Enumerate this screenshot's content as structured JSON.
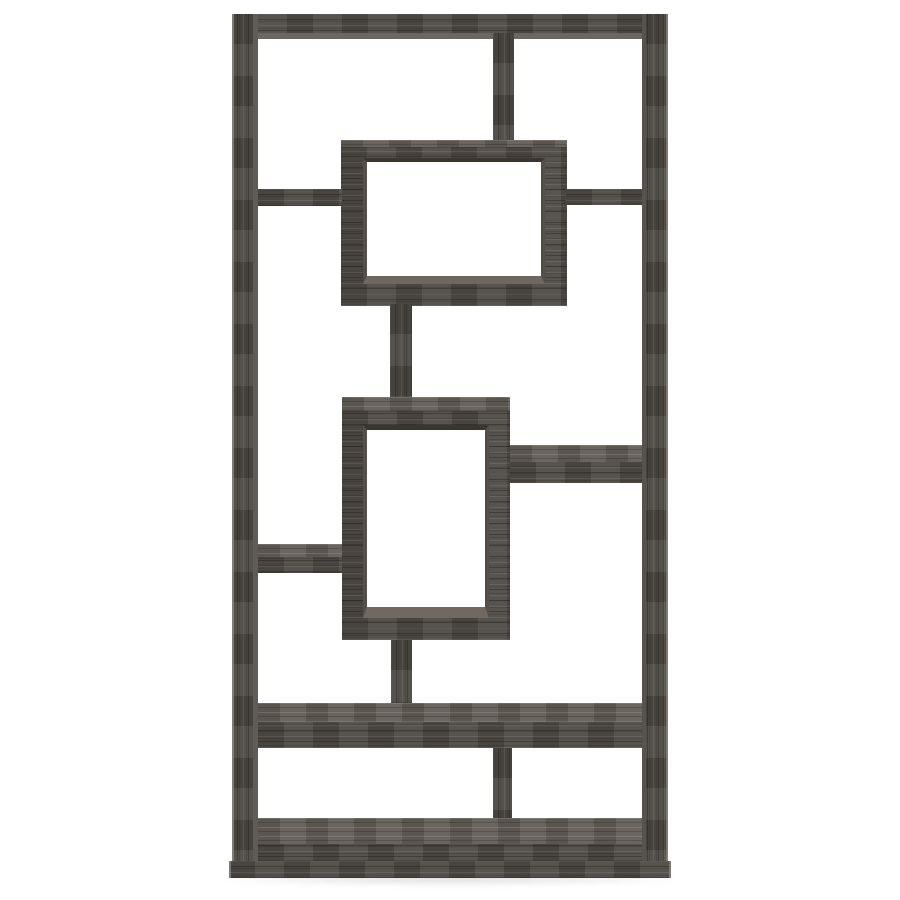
{
  "scene": {
    "type": "product-photograph",
    "alt": "Weathered grey geometric bookcase with interlocking open shelves on a white background",
    "object_name": "10-shelf geometric bookcase",
    "finish_name": "weathered grey rustic woodgrain",
    "background_color": "#ffffff",
    "palette": {
      "wood_front": "#4e4a45",
      "wood_top_face": "#615b54",
      "wood_streak_light": "#756e65",
      "wood_streak_dark": "#39352f",
      "edge_highlight": "#8d8780",
      "interior_shadow": "#3a362f",
      "interior_lit": "#6f6962",
      "floor_shadow": "rgba(0,0,0,0.14)"
    }
  },
  "parts": [
    {
      "id": "top-board",
      "label": "top panel"
    },
    {
      "id": "left-post",
      "label": "left side panel"
    },
    {
      "id": "right-post",
      "label": "right side panel"
    },
    {
      "id": "top-divider",
      "label": "upper vertical divider"
    },
    {
      "id": "upper-box",
      "label": "upper floating shelf box"
    },
    {
      "id": "top-left-shelf",
      "label": "upper left shelf"
    },
    {
      "id": "top-right-shelf",
      "label": "upper right shelf"
    },
    {
      "id": "upper-stem",
      "label": "upper connecting post"
    },
    {
      "id": "middle-box",
      "label": "middle floating shelf box"
    },
    {
      "id": "mid-right-shelf",
      "label": "middle right shelf"
    },
    {
      "id": "mid-left-shelf",
      "label": "middle left shelf"
    },
    {
      "id": "lower-stem",
      "label": "lower connecting post"
    },
    {
      "id": "lower-shelf",
      "label": "lower full-width shelf"
    },
    {
      "id": "lower-divider",
      "label": "lower vertical divider"
    },
    {
      "id": "bottom-shelf",
      "label": "bottom shelf"
    },
    {
      "id": "base",
      "label": "base plinth"
    }
  ]
}
